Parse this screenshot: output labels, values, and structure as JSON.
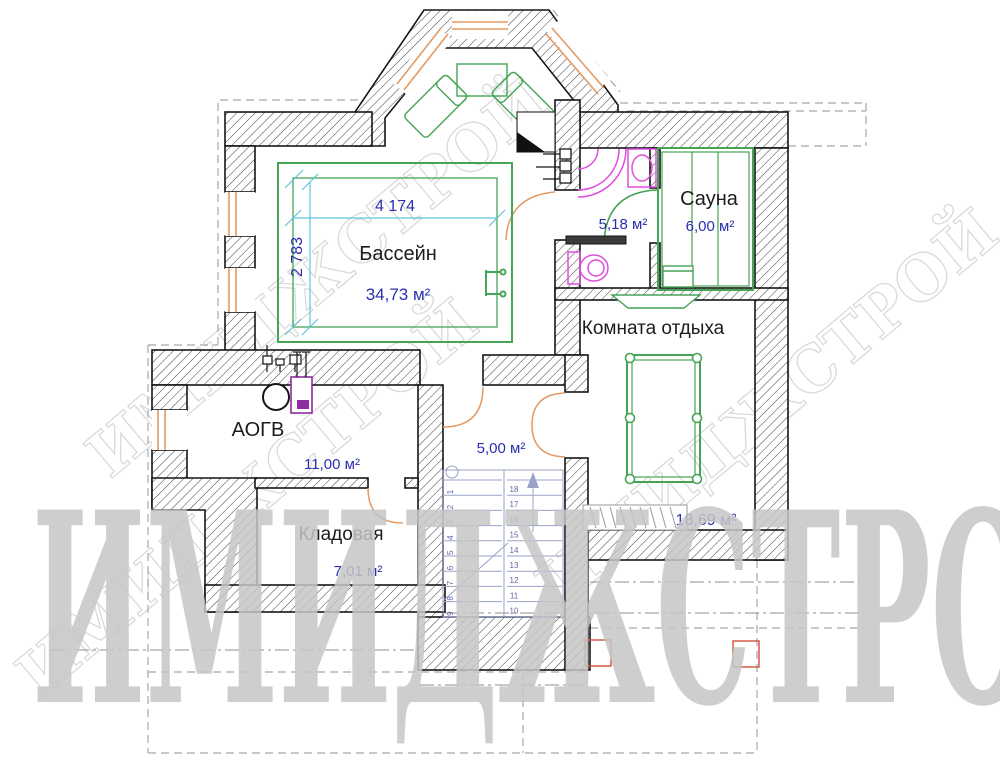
{
  "watermark": {
    "text": "ИМИДЖСТРОЙ"
  },
  "rooms": {
    "pool": {
      "name": "Бассейн",
      "area": "34,73 м²"
    },
    "bath": {
      "area": "5,18 м²"
    },
    "sauna": {
      "name": "Сауна",
      "area": "6,00 м²"
    },
    "lounge": {
      "name": "Комната отдыха",
      "area": "18,69 м²"
    },
    "boiler": {
      "name": "АОГВ",
      "area": "11,00 м²"
    },
    "hall": {
      "area": "5,00 м²"
    },
    "storage": {
      "name": "Кладовая",
      "area": "7,01 м²"
    }
  },
  "dimensions": {
    "pool_width": "4 174",
    "pool_height": "2 783"
  },
  "stairs": {
    "left_numbers": [
      "1",
      "2",
      "3",
      "4",
      "5",
      "6",
      "7",
      "8",
      "9"
    ],
    "right_numbers": [
      "18",
      "17",
      "16",
      "15",
      "14",
      "13",
      "12",
      "11",
      "10"
    ]
  },
  "colors": {
    "wall_outline": "#161616",
    "furniture_green": "#3ea04e",
    "joinery_orange": "#e39a63",
    "sanitary_magenta": "#e04ee0",
    "boiler_purple": "#8e2d9e",
    "dim_blue": "#2b2fae",
    "dim_line_cyan": "#5fc3dc",
    "stairs_blue": "#8f97c2",
    "column_red": "#d05038",
    "watermark_gray": "#c5c5c5"
  }
}
